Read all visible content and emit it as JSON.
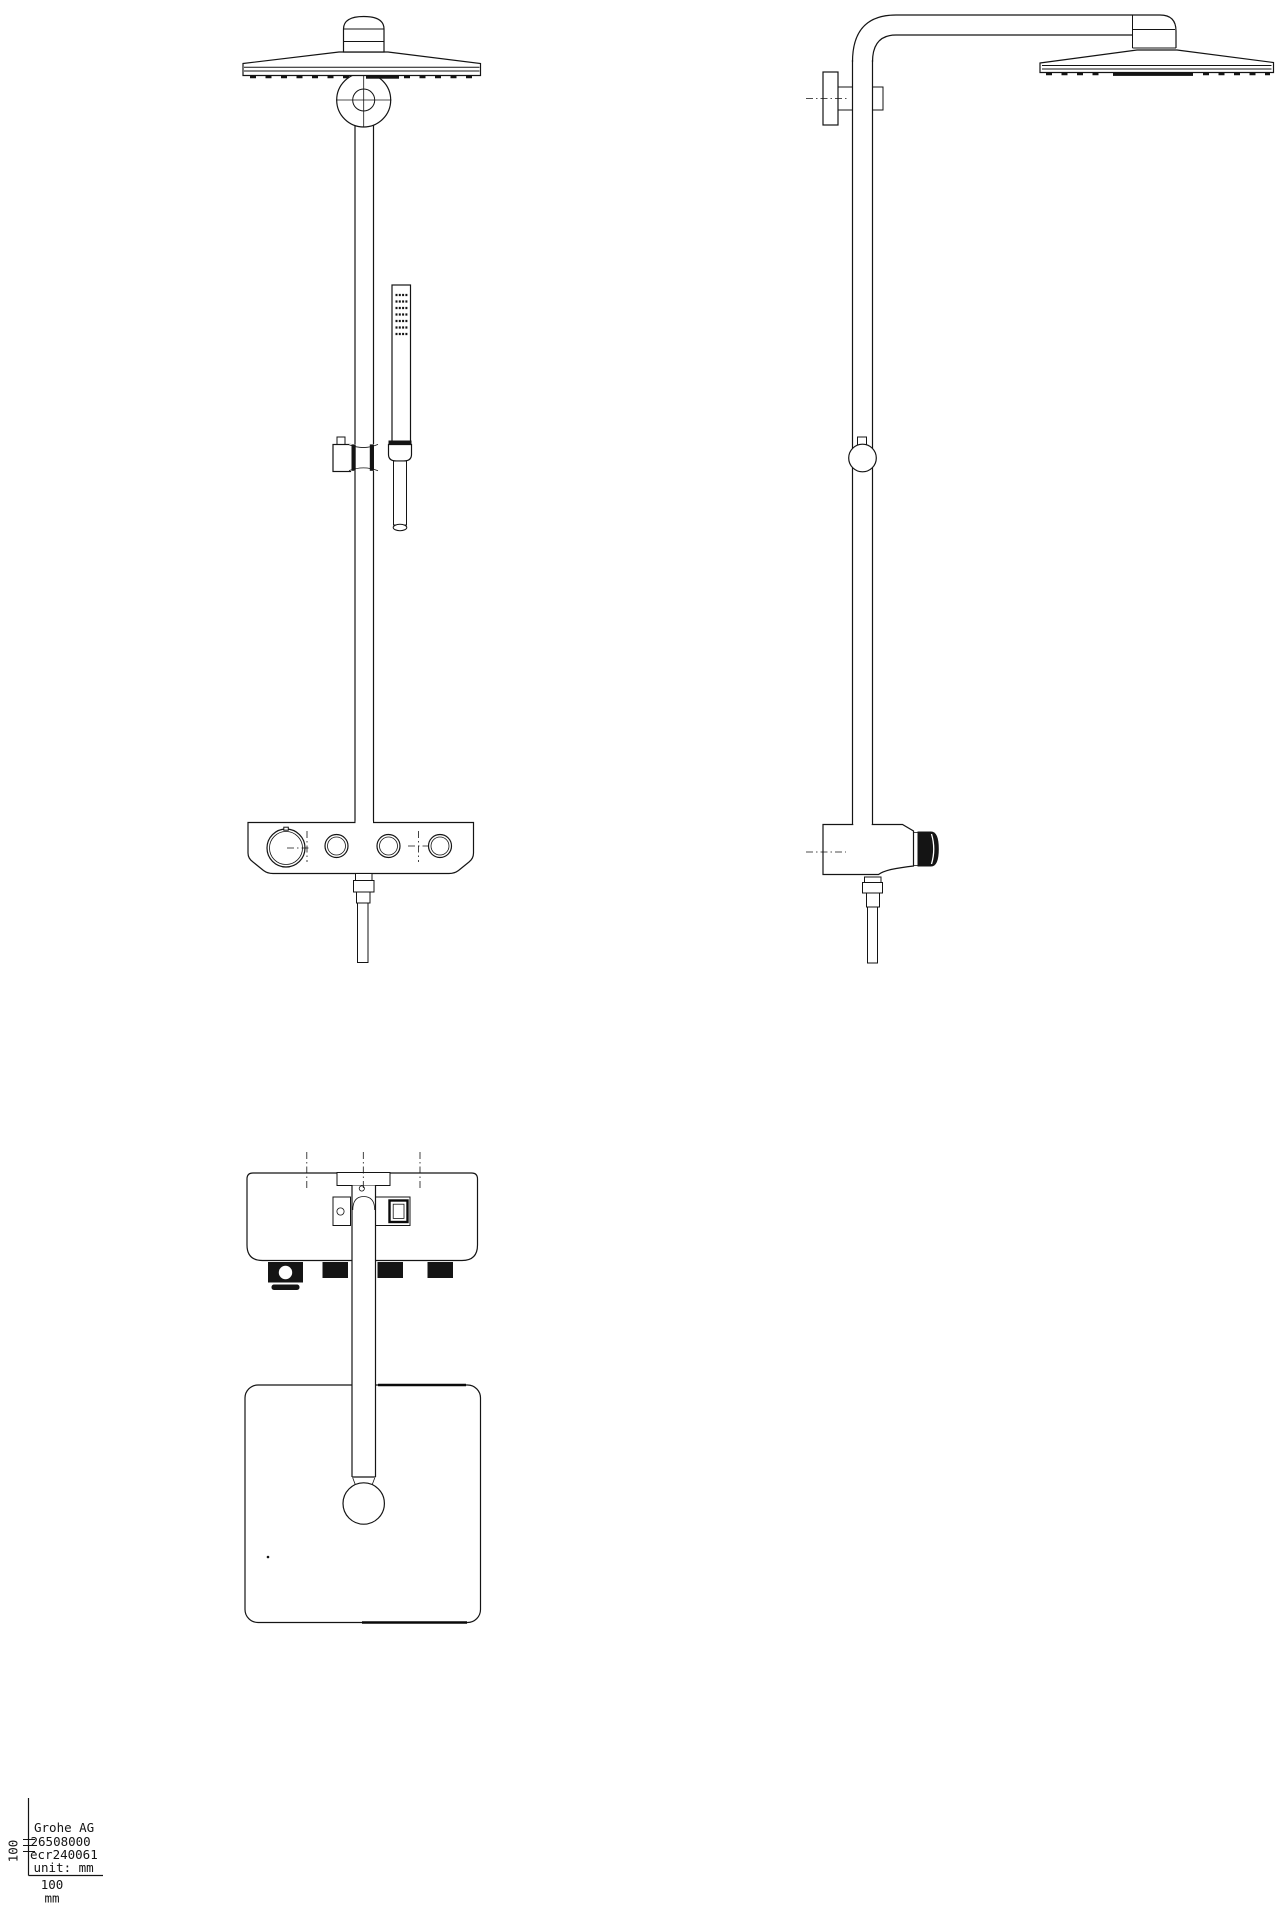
{
  "title_block": {
    "company": "Grohe AG",
    "model_number": "26508000",
    "ecr_number": "ecr240061",
    "unit_note": "unit: mm",
    "scale_x_value": "100",
    "scale_x_unit": "mm",
    "scale_y_value": "100"
  },
  "colors": {
    "line": "#141414",
    "background": "#ffffff"
  }
}
